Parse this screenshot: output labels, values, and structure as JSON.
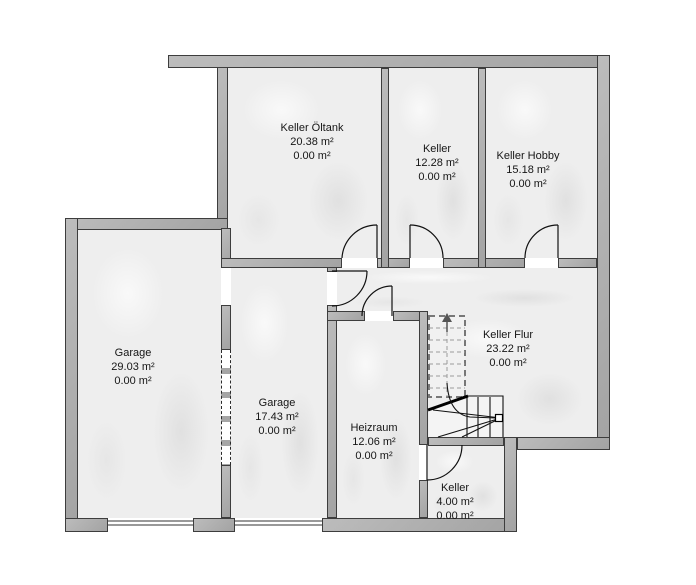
{
  "rooms": {
    "keller_oeltank": {
      "name": "Keller Öltank",
      "area": "20.38 m²",
      "area2": "0.00 m²"
    },
    "keller_mid": {
      "name": "Keller",
      "area": "12.28 m²",
      "area2": "0.00 m²"
    },
    "keller_hobby": {
      "name": "Keller Hobby",
      "area": "15.18 m²",
      "area2": "0.00 m²"
    },
    "garage_large": {
      "name": "Garage",
      "area": "29.03 m²",
      "area2": "0.00 m²"
    },
    "garage_small": {
      "name": "Garage",
      "area": "17.43 m²",
      "area2": "0.00 m²"
    },
    "heizraum": {
      "name": "Heizraum",
      "area": "12.06 m²",
      "area2": "0.00 m²"
    },
    "keller_flur": {
      "name": "Keller Flur",
      "area": "23.22 m²",
      "area2": "0.00 m²"
    },
    "keller_small": {
      "name": "Keller",
      "area": "4.00 m²",
      "area2": "0.00 m²"
    }
  },
  "colors": {
    "wall_fill": "#aeaeae",
    "wall_edge": "#3d3d3d",
    "room_fill": "#eeeeee",
    "line": "#111111",
    "stair_dash": "#777777",
    "background": "#ffffff"
  }
}
